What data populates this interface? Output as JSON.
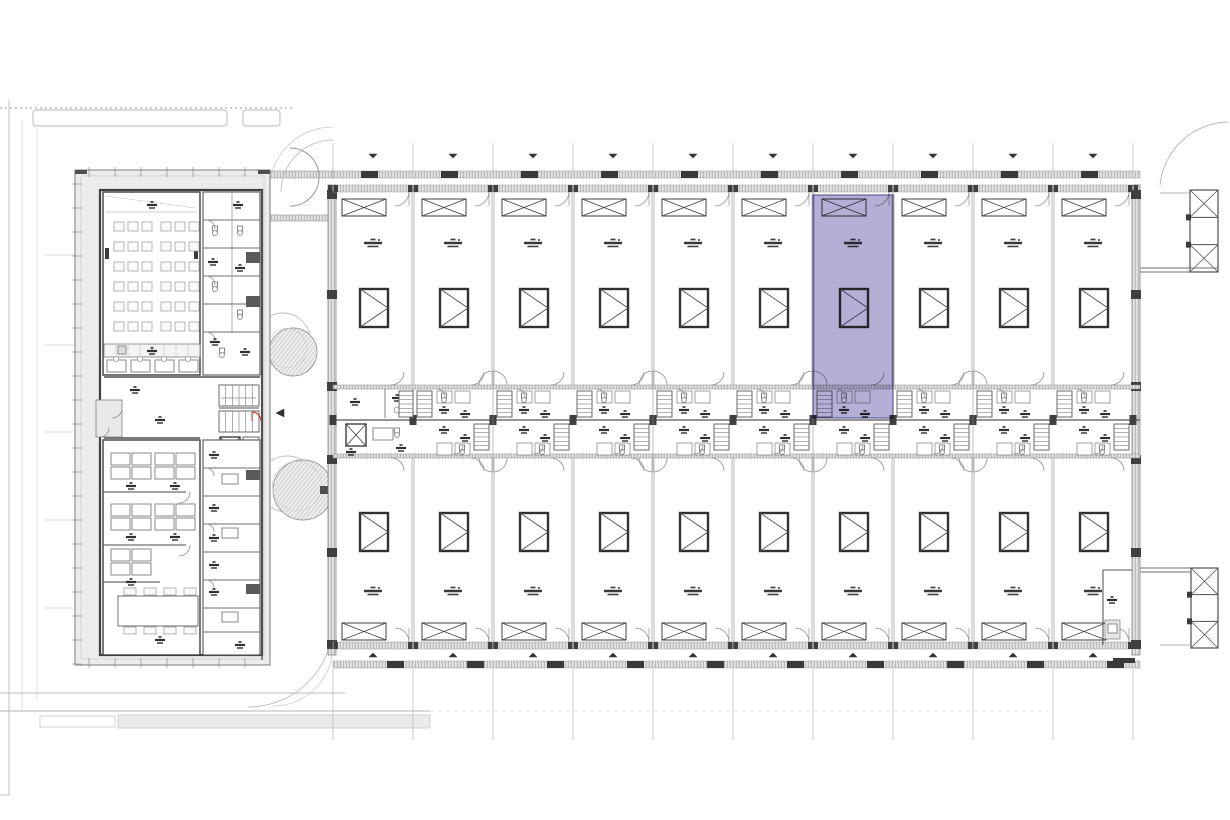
{
  "drawing": {
    "kind": "architectural-floor-plan",
    "canvas": {
      "width": 1230,
      "height": 820,
      "background": "#ffffff"
    },
    "colors": {
      "ink": "#3f3f3f",
      "wall_dark": "#4a4a4a",
      "wall_mid": "#8a8a8a",
      "line_light": "#bdbdbd",
      "band_fill": "#e4e4e4",
      "band_stroke": "#9a9a9a",
      "walk_fill": "#ececec",
      "glyph": "#2f2f2f",
      "tree_stroke": "#9b9b9b",
      "tree_outline": "#c2c2c2",
      "highlight_fill": "#6f68ae",
      "highlight_stroke": "#4a4590",
      "highlight_opacity": 0.52,
      "red_accent": "#c0392b"
    },
    "main_building": {
      "left": 333,
      "right": 1140,
      "top_wall": 171,
      "inner_top": 185,
      "bottom_inner": 645,
      "bottom_outer": 669,
      "corridor_top": 385,
      "corridor_bottom": 458,
      "mid_wall": 420,
      "unit_pitch": 80,
      "unit_count": 10,
      "rows": [
        "north",
        "south"
      ],
      "selected_unit": {
        "row": "north",
        "index": 7
      },
      "units_north": [
        {
          "id": "north-1",
          "selected": false
        },
        {
          "id": "north-2",
          "selected": false
        },
        {
          "id": "north-3",
          "selected": false
        },
        {
          "id": "north-4",
          "selected": false
        },
        {
          "id": "north-5",
          "selected": false
        },
        {
          "id": "north-6",
          "selected": false
        },
        {
          "id": "north-7",
          "selected": true
        },
        {
          "id": "north-8",
          "selected": false
        },
        {
          "id": "north-9",
          "selected": false
        },
        {
          "id": "north-10",
          "selected": false
        }
      ],
      "units_south": [
        {
          "id": "south-1",
          "selected": false
        },
        {
          "id": "south-2",
          "selected": false
        },
        {
          "id": "south-3",
          "selected": false
        },
        {
          "id": "south-4",
          "selected": false
        },
        {
          "id": "south-5",
          "selected": false
        },
        {
          "id": "south-6",
          "selected": false
        },
        {
          "id": "south-7",
          "selected": false
        },
        {
          "id": "south-8",
          "selected": false
        },
        {
          "id": "south-9",
          "selected": false
        },
        {
          "id": "south-10",
          "selected": false
        }
      ],
      "highlight_rect": {
        "x": 813,
        "y": 195,
        "w": 80,
        "h": 223
      }
    },
    "left_building": {
      "outer": {
        "x": 75,
        "y": 170,
        "w": 195,
        "h": 495
      },
      "inner": {
        "x": 100,
        "y": 190,
        "w": 162,
        "h": 465
      },
      "seminar_room": {
        "chair_rows": 6,
        "chair_groups": 2,
        "chairs_per_group": 3
      },
      "work_desks_row": 4,
      "office_clusters": [
        {
          "cx": 131,
          "cy": 466
        },
        {
          "cx": 175,
          "cy": 466
        },
        {
          "cx": 131,
          "cy": 517
        },
        {
          "cx": 175,
          "cy": 517
        },
        {
          "cx": 131,
          "cy": 562
        }
      ],
      "meeting_table": {
        "x": 118,
        "y": 596,
        "w": 80,
        "h": 30,
        "chairs": 8
      },
      "core_cells": 6,
      "side_office_cells": 7
    },
    "courtyard": {
      "trees": [
        {
          "outline": {
            "cx": 283,
            "cy": 340,
            "r": 27
          },
          "canopy": {
            "cx": 293,
            "cy": 352,
            "r": 24
          }
        },
        {
          "outline": {
            "cx": 287,
            "cy": 484,
            "r": 28
          },
          "canopy": {
            "cx": 303,
            "cy": 490,
            "r": 30
          }
        }
      ]
    },
    "towers": [
      {
        "x": 1190,
        "y": 190,
        "w": 28,
        "h": 82,
        "cells": 3
      },
      {
        "x": 1191,
        "y": 568,
        "w": 27,
        "h": 80,
        "cells": 3
      }
    ],
    "site": {
      "top_dotted_y": 108,
      "planters_top": [
        {
          "x": 33,
          "y": 110,
          "w": 194,
          "h": 16
        },
        {
          "x": 243,
          "y": 110,
          "w": 37,
          "h": 16
        }
      ],
      "bottom_line_y1": 693,
      "bottom_line_y2": 711,
      "bottom_band": {
        "x": 118,
        "y": 715,
        "w": 312,
        "h": 13
      },
      "grid_line_count": 11
    }
  }
}
